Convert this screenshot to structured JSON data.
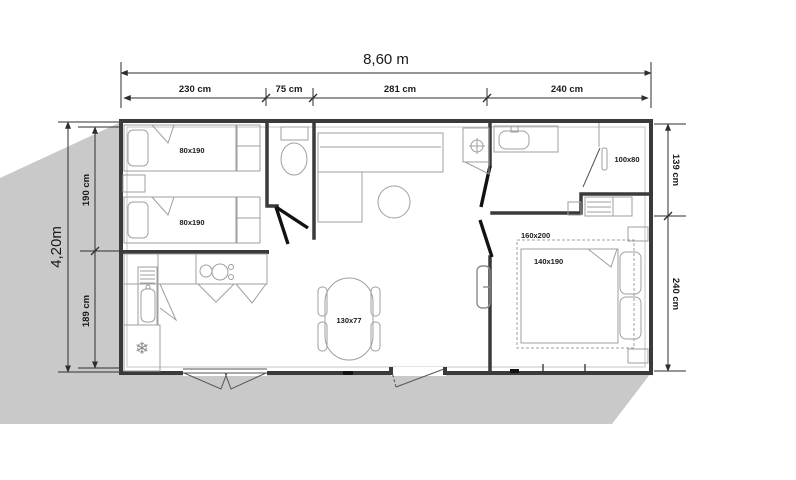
{
  "plan": {
    "total_width_label": "8,60 m",
    "total_height_label": "4,20m",
    "dims_top": [
      "230 cm",
      "75 cm",
      "281 cm",
      "240 cm"
    ],
    "dims_left": [
      "190 cm",
      "189 cm"
    ],
    "dims_right": [
      "139 cm",
      "240 cm"
    ],
    "labels": {
      "bed_single_1": "80x190",
      "bed_single_2": "80x190",
      "shower": "100x80",
      "bed_zone": "160x200",
      "bed_double": "140x190",
      "dining_table": "130x77"
    },
    "icons": {
      "fridge_snowflake": "❄"
    },
    "colors": {
      "ground_shadow": "#c9c9c9",
      "wall": "#3a3a3a",
      "furniture_line": "#9f9f9f",
      "door_leaf": "#121212",
      "background": "#ffffff"
    }
  }
}
